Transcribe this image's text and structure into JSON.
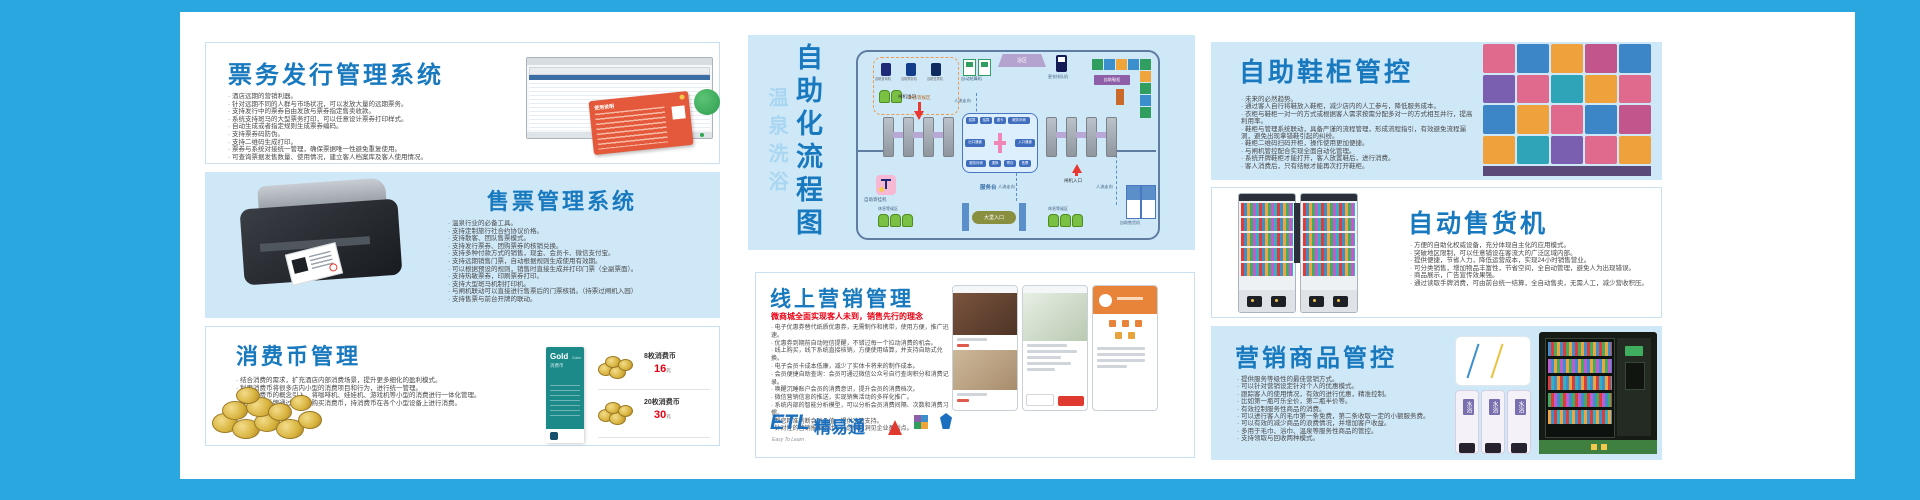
{
  "colors": {
    "frame_blue": "#2ba7e0",
    "panel_blue": "#cfe8f8",
    "title_blue": "#1879bf",
    "accent_red": "#e60012",
    "teal_card": "#1d8a8a"
  },
  "panels": {
    "ticket_issue": {
      "title": "票务发行管理系统",
      "card_title": "使用说明",
      "bullets": [
        "酒店远期的营销利器。",
        "针对远期不同的人群与市场状况，可以发放大量的远期票务。",
        "支持发行中的票券自由发放与票券指定售卖收款。",
        "系统支持斑马的大型票务打印，可以任意设计票券打印样式。",
        "自动生成或者指定规则生成票券编码。",
        "支持票券码防伪。",
        "支持二维码生成打印。",
        "票券与系统对接统一管理，确保票据唯一性避免重复使用。",
        "可查询票据发售数量、使用情况，建立客人档案库及客人使用情况。"
      ]
    },
    "ticket_sale": {
      "title": "售票管理系统",
      "bullets": [
        "温泉行业的必备工具。",
        "支持定制旅行社合约协议价格。",
        "支持散客、团队售票模式。",
        "支持发行票券、团购票券的核销兑换。",
        "支持多种付款方式的销售，现金、会员卡、微信支付宝。",
        "支持远期销售门票，自动根据规则生成使用有效期。",
        "可以根据预设的规则，销售时直接生成并打印门票（全副票面）。",
        "支持热敏票券，印刷票券打印。",
        "支持大型斑马机制打印机。",
        "与闸机联动可以直接进行售票后的门票核销。（持票过闸机入园）",
        "支持售票与前台开牌的联动。"
      ]
    },
    "coin": {
      "title": "消费币管理",
      "bullets": [
        "结合消费的需求，扩充酒店内部消费场景，提升更多细化的盈利模式。",
        "利用消费币将很多店内小型的消费项目和行为，进行统一管理。",
        "利用消费币的概念引入，将咖啡机、娃娃机、游戏机等小型的消费进行一体化管理。",
        "客人利用手牌通过发币机购买消费币，持消费币在各个小型设备上进行消费。"
      ],
      "card": {
        "line1": "Gold",
        "line2": "Coins",
        "line3": "消费币"
      },
      "prices": [
        {
          "name": "8枚消费币",
          "price": "16",
          "unit": "元"
        },
        {
          "name": "20枚消费币",
          "price": "30",
          "unit": "元"
        }
      ]
    },
    "flow": {
      "title_side": "温泉洗浴",
      "title_main": "自助化流程图",
      "labels": {
        "rest_wait": "休息等候区",
        "kiosk1": "自助查询机",
        "kiosk2": "自助票务机",
        "kiosk3": "自助售票机",
        "auto_checkout": "自动结算机",
        "bath_zone": "浴区",
        "queue_machine": "更衣排队机",
        "shoe_cabinet": "自助鞋柜",
        "flow_dir": "人流走向",
        "gate_exit": "闸机出口",
        "gate_entry": "闸机入口",
        "service_desk": "服务台",
        "lobby_entry": "大堂入口",
        "deposit_machine": "自助寄挂机",
        "vending_machine": "自助售货机"
      },
      "chips": [
        "结算",
        "结算",
        "退卡",
        "服务问询",
        "出口通道",
        "入口通道",
        "服务问询",
        "退换",
        "寄存",
        "售票"
      ]
    },
    "shoe": {
      "title": "自助鞋柜管控",
      "bullets": [
        "未来的必然趋势。",
        "通过客人自行将鞋放入鞋柜，减少店内的人工参与，降低服务成本。",
        "衣柜与鞋柜一对一的方式或根据客人需求按需分配多对一的方式相互并行，提高利用率。",
        "鞋柜与管理系统联动，具备严谨的流程管理，形成流程指引，有效避免流程漏洞，避免出现拿错鞋引起的纠纷。",
        "鞋柜二维码扫码开柜，操作使用更加便捷。",
        "与闸机管控配合实现全面自动化管理。",
        "系统开牌鞋柜才能打开，客人放置鞋后，进行消费。",
        "客人消费后，只有结帐才能再次打开鞋柜。"
      ]
    },
    "vending": {
      "title": "自动售货机",
      "bullets": [
        "方便的自助化权威设备，充分体现自主化的应用模式。",
        "突破地区限制，可以任意铺设在客流大的广泛区域内部。",
        "提供便捷，节省人力，降低运营成本，实现24小时销售营业。",
        "可分类销售，增加物品丰富性，节省空间，全自动管理，避免人为出现错误。",
        "商品展示，广告宣传效果强。",
        "通过读取手牌消费，可由前台统一结算，全自动售卖，无需人工，减少营收积压。"
      ]
    },
    "goods": {
      "title": "营销商品管控",
      "bottle_label": "水浴",
      "bullets": [
        "提供服务等级性的最佳营销方式。",
        "可以针对营销设定针对个人的优惠模式。",
        "跟踪客人的使用情况，有效的进行优惠，精准控制。",
        "比如第一瓶可乐全价，第二瓶半价等。",
        "有效控制服务性商品的消费。",
        "可以进行客人的毛巾第一条免费，第二条收取一定的小额服务费。",
        "可以有效的减少商品的浪费情况，并增加客户收益。",
        "多用于毛巾、浴巾、温泉等服务性商品的管控。",
        "支持领取与回收两种模式。"
      ]
    },
    "online": {
      "title": "线上营销管理",
      "subtitle": "微商城全面实现客人未到，销售先行的理念",
      "bullets": [
        "电子优惠券替代纸质优惠券，无需制作和携带，使用方便，推广迅速。",
        "优惠券到期前自动短信提醒，不错过每一个拉动消费的机会。",
        "线上购买，线下系统直接核销，方便使用结算，并支持自助式兑换。",
        "电子会员卡成本低廉，减少了实体卡将来的制作成本。",
        "会员便捷自助查询：会员可通过微信公众号自行查询积分和消费记录。",
        "唤醒沉睡账户会员的消费意识，提升会员的消费档次。",
        "微信营销信息的推送，实现销售活动的多样化推广。",
        "系统内部的智能分析模型，可以分析会员消费间隔、次数和消费习惯。",
        "帮您精准判断会员价值，提供决策支持。",
        "针对性的营销报表统计，让您快速洞见企业盈利点。"
      ],
      "logo": {
        "etl": "ETL",
        "brand": "精易通",
        "tagline": "Easy To Learn"
      }
    }
  }
}
